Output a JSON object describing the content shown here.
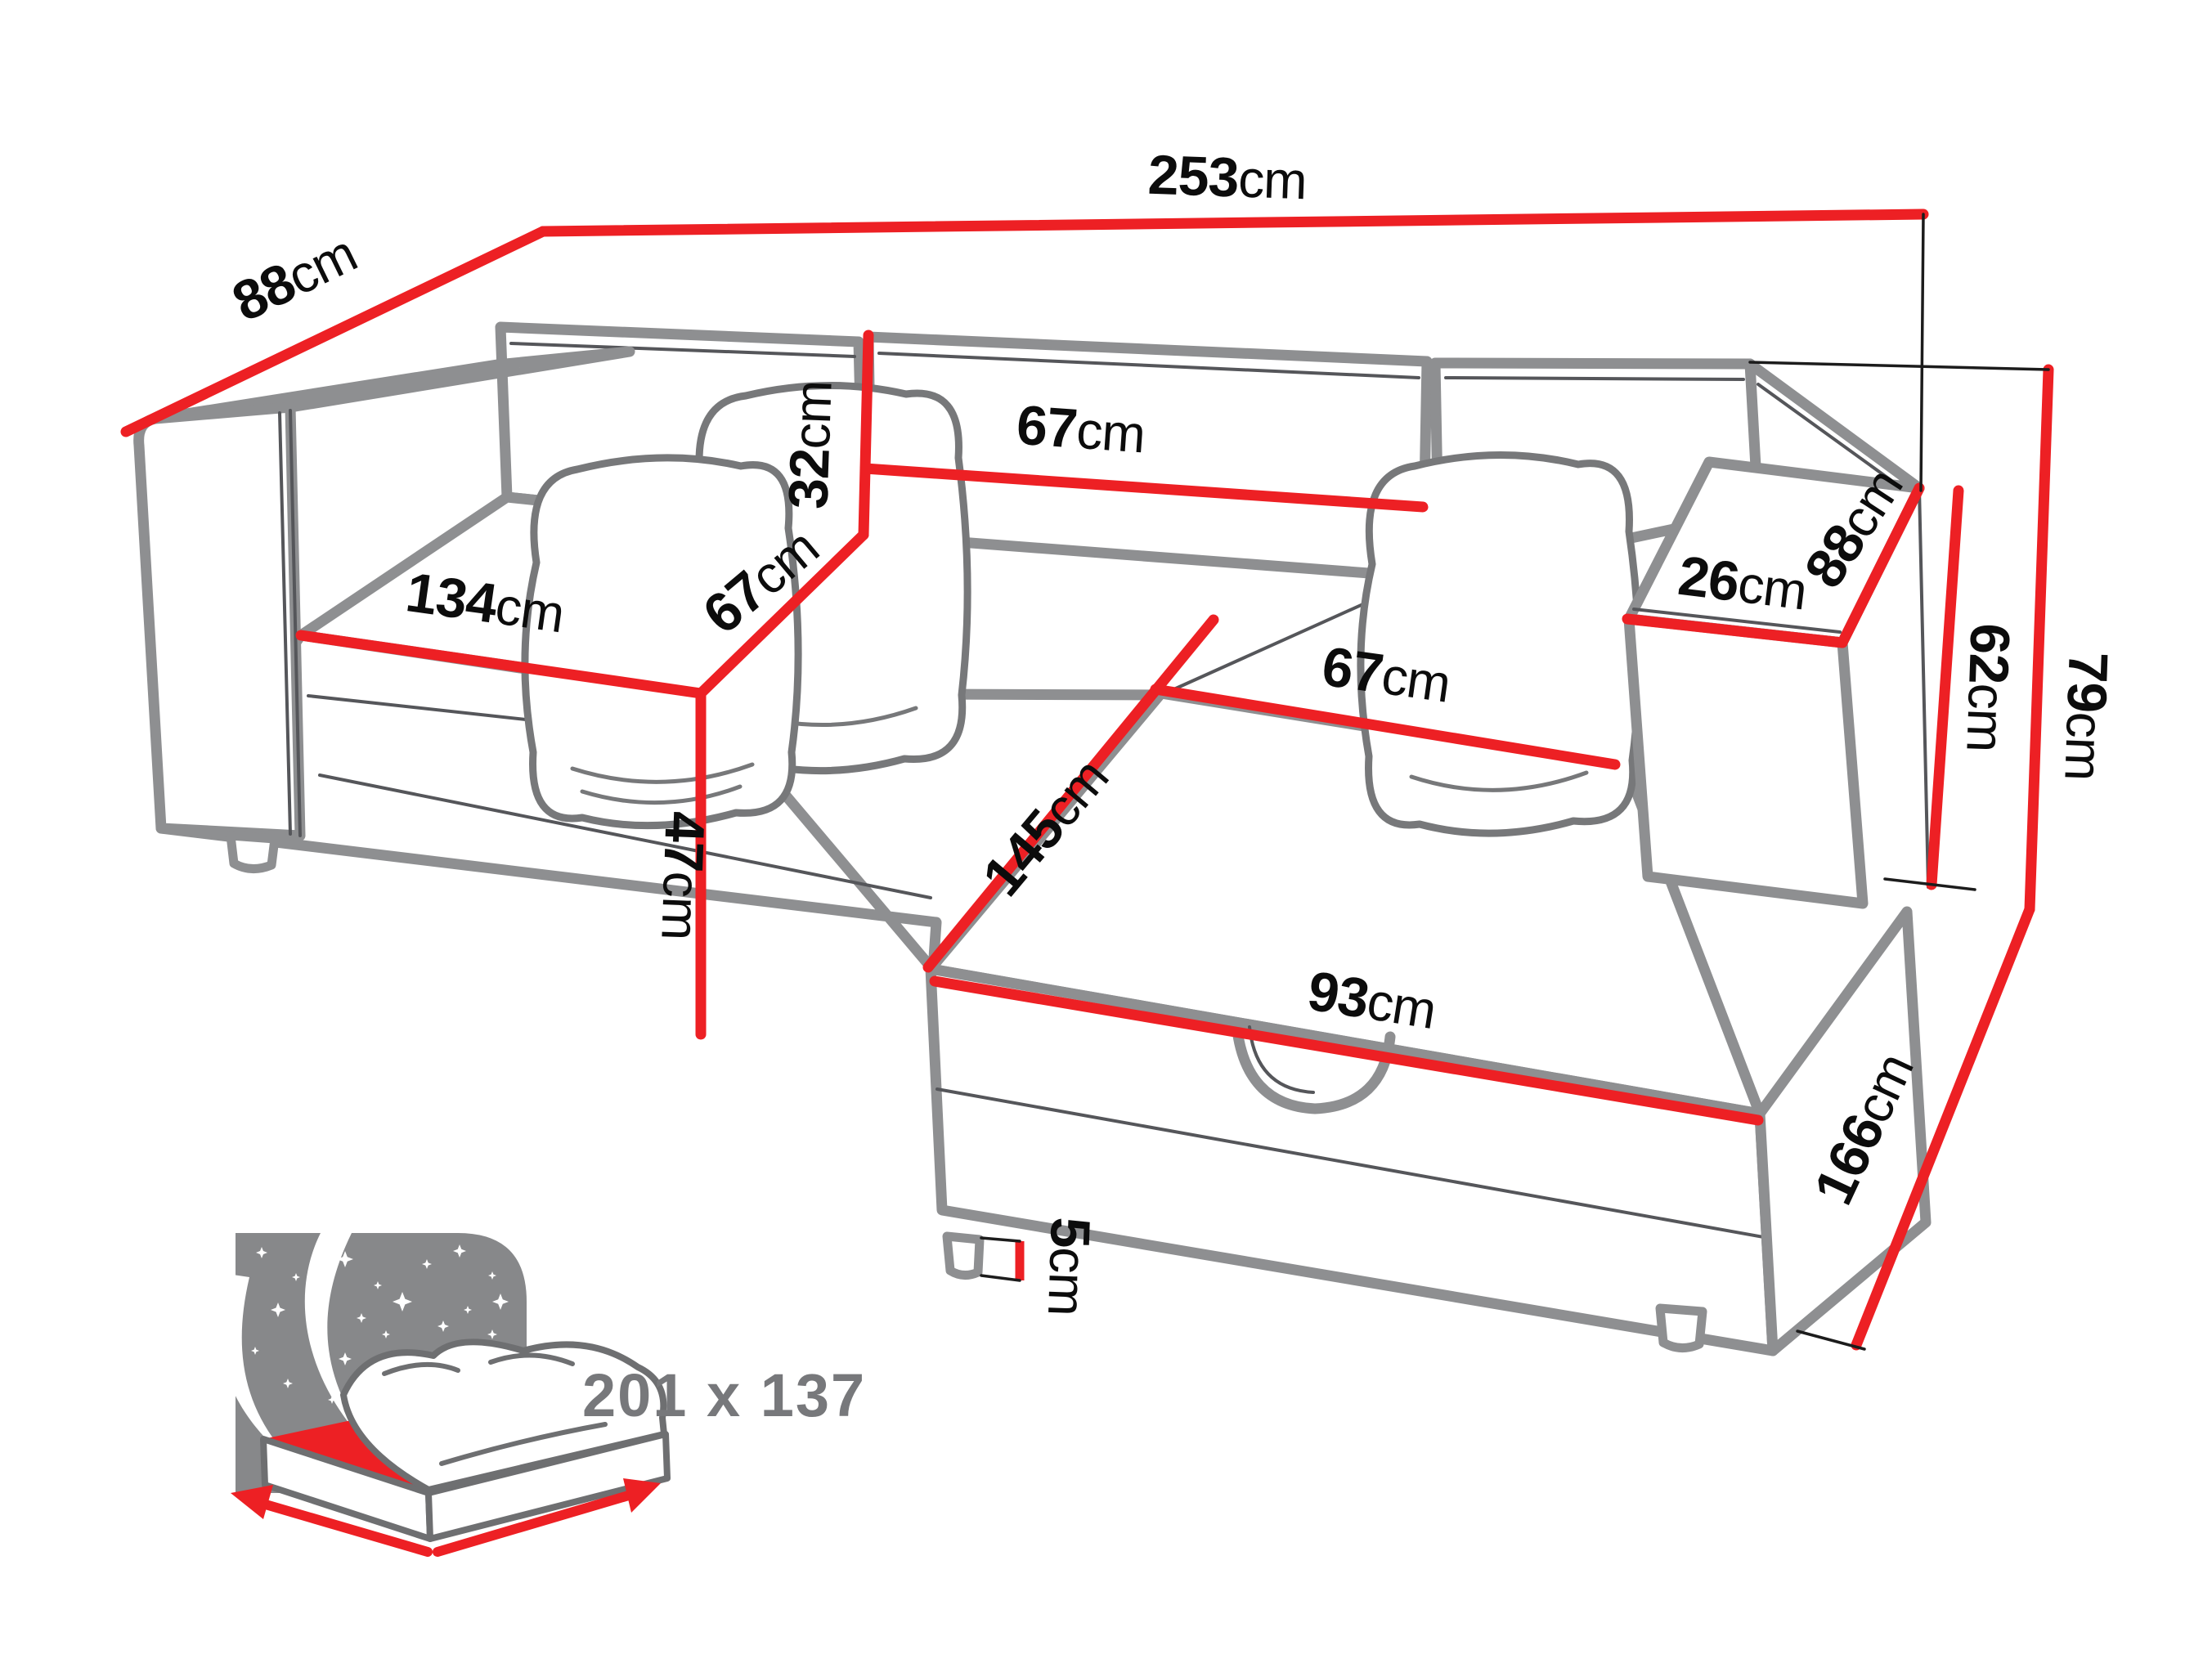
{
  "diagram": {
    "subject": "corner sofa bed with chaise and storage",
    "style": "technical dimension line drawing"
  },
  "colors": {
    "dimension_line": "#ed2024",
    "outline_gray": "#8e8f91",
    "detail_line": "#55565a",
    "label_text": "#0c0c0c",
    "bed_size_text": "#77787b",
    "icon_background": "#87888a"
  },
  "dimensions": {
    "back_depth": {
      "value": "88",
      "unit": "cm"
    },
    "total_width": {
      "value": "253",
      "unit": "cm"
    },
    "backrest_height": {
      "value": "32",
      "unit": "cm"
    },
    "backrest_width": {
      "value": "67",
      "unit": "cm"
    },
    "seat_front_width": {
      "value": "134",
      "unit": "cm"
    },
    "seat_depth": {
      "value": "67",
      "unit": "cm"
    },
    "seat_height": {
      "value": "47",
      "unit": "cm"
    },
    "chaise_top_width": {
      "value": "67",
      "unit": "cm"
    },
    "chaise_length": {
      "value": "145",
      "unit": "cm"
    },
    "chaise_front_width": {
      "value": "93",
      "unit": "cm"
    },
    "leg_height": {
      "value": "5",
      "unit": "cm"
    },
    "armrest_width": {
      "value": "26",
      "unit": "cm"
    },
    "armrest_depth": {
      "value": "88",
      "unit": "cm"
    },
    "armrest_height": {
      "value": "62",
      "unit": "cm"
    },
    "total_height": {
      "value": "79",
      "unit": "cm"
    },
    "side_depth": {
      "value": "166",
      "unit": "cm"
    }
  },
  "sleeping_area": {
    "label": "201 x 137",
    "icon": "bed-with-mattress-and-starry-night"
  }
}
